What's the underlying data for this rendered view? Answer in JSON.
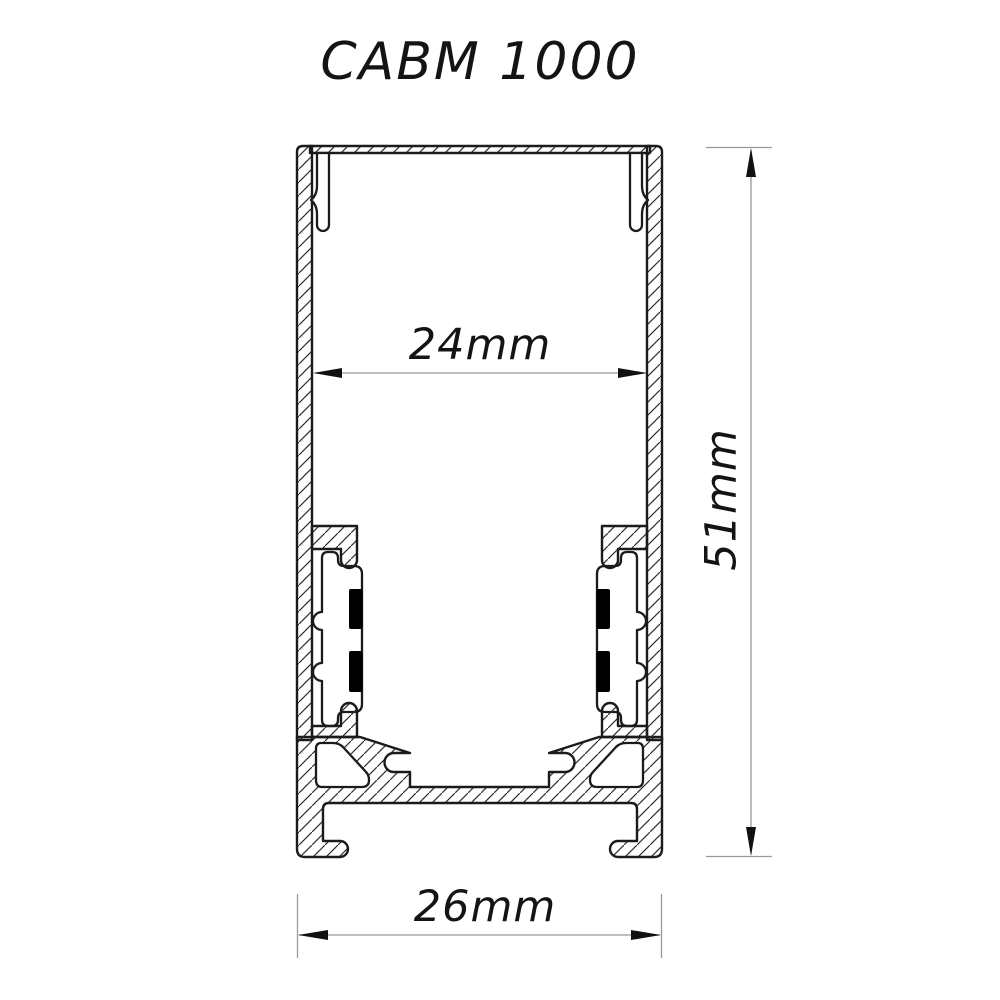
{
  "title": "CABM 1000",
  "drawing": {
    "type": "profile-cross-section",
    "description": "Aluminium LED profile cross section with hatched walls, cover lips, LED strip clip towers with rubber pads, screw ports and bottom mounting channel"
  },
  "dimensions": {
    "inner_width": {
      "label": "24mm",
      "value": 24,
      "unit": "mm"
    },
    "height": {
      "label": "51mm",
      "value": 51,
      "unit": "mm"
    },
    "outer_width": {
      "label": "26mm",
      "value": 26,
      "unit": "mm"
    }
  },
  "colors": {
    "outline": "#1b1b1b",
    "hatch": "#2e2e2e",
    "dimension_line": "#999999",
    "arrow": "#111111",
    "text": "#141414",
    "pad": "#000000",
    "background": "#ffffff"
  }
}
